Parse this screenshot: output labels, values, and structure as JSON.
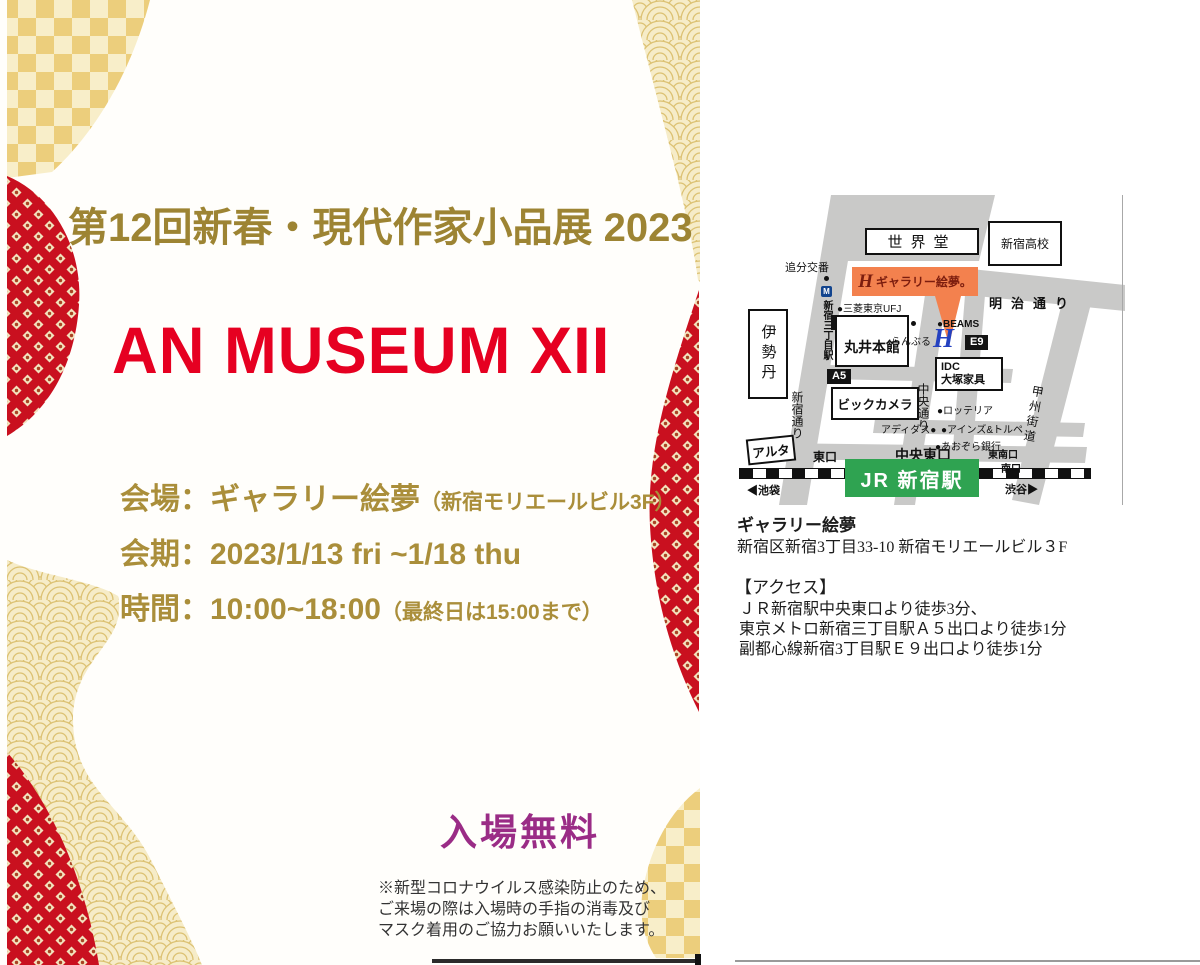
{
  "flyer": {
    "title": "第12回新春・現代作家小品展 2023",
    "main_title": "AN MUSEUM XII",
    "venue_label": "会場：ギャラリー絵夢",
    "venue_note": "（新宿モリエールビル3F）",
    "dates": "会期：2023/1/13 fri ~1/18 thu",
    "hours": "時間：10:00~18:00",
    "hours_note": "（最終日は15:00まで）",
    "admission": "入場無料",
    "covid_note_lines": [
      "※新型コロナウイルス感染防止のため、",
      "ご来場の際は入場時の手指の消毒及び",
      "マスク着用のご協力お願いいたします。"
    ]
  },
  "info": {
    "gallery_name": "ギャラリー絵夢",
    "address": "新宿区新宿3丁目33-10  新宿モリエールビル３F",
    "access_heading": "【アクセス】",
    "access_lines": [
      "ＪＲ新宿駅中央東口より徒歩3分、",
      "東京メトロ新宿三丁目駅Ａ５出口より徒歩1分",
      "副都心線新宿3丁目駅Ｅ９出口より徒歩1分"
    ]
  },
  "map": {
    "labels": {
      "sekaido": "世界堂",
      "shinjuku_koko": "新宿高校",
      "oiwake_koban": "追分交番",
      "banner_logo": "H",
      "gallery_banner": "ギャラリー絵夢。",
      "meiji_dori": "明治通り",
      "metro_station": "新宿三丁目駅",
      "metro_icon": "M",
      "mitsubishi_ufj": "●三菱東京UFJ",
      "a1": "A1",
      "marui_honkan": "丸井本館",
      "ranburu": "らんぶる",
      "beams": "●BEAMS",
      "blue_logo": "H",
      "e9": "E9",
      "idc_line1": "IDC",
      "idc_line2": "大塚家具",
      "isetan": "伊勢丹",
      "a5": "A5",
      "bic_camera": "ビックカメラ",
      "chuo_dori": "中央通り",
      "lotteria": "●ロッテリア",
      "adidas": "アディダス●",
      "ainz_tulpe": "●アインズ&トルペ",
      "aozora_bank": "●あおぞら銀行",
      "chuo_higashi_exit": "中央東口",
      "tonan_exit": "東南口",
      "shinjuku_dori": "新宿通り",
      "alta": "アルタ",
      "higashi_exit": "東口",
      "jr_shinjuku_station": "JR 新宿駅",
      "minami_exit": "南口",
      "ikebukuro": "◀池袋",
      "shibuya": "渋谷▶",
      "koshu_kaido": "甲州街道"
    }
  },
  "colors": {
    "accent_red": "#e60021",
    "title_gold": "#9d8433",
    "info_gold": "#aa8e3a",
    "admission_purple": "#9a2c86",
    "banner_orange": "#f3814e",
    "jr_green": "#2fa351",
    "logo_blue": "#2441c0",
    "pattern_red": "#c9101f",
    "pattern_gold": "#ecce7c",
    "pattern_cream": "#f8eec9",
    "road_gray": "#c9c9c8"
  }
}
